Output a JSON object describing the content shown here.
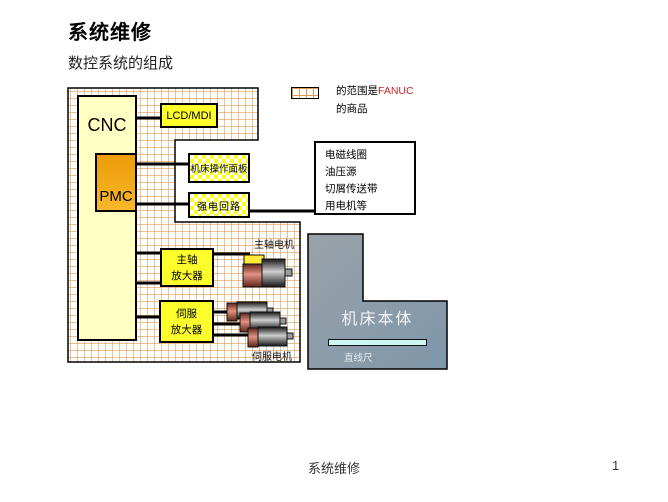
{
  "slide": {
    "title": "系统维修",
    "subtitle": "数控系统的组成",
    "footer_text": "系统维修",
    "page_number": "1"
  },
  "diagram": {
    "cnc_label": "CNC",
    "pmc_label": "PMC",
    "lcd_mdi_label": "LCD/MDI",
    "operator_panel_label": "机床操作面板",
    "power_circuit_label": "强电回路",
    "spindle_amp": {
      "line1": "主轴",
      "line2": "放大器"
    },
    "servo_amp": {
      "line1": "伺服",
      "line2": "放大器"
    },
    "spindle_motor_label": "主轴电机",
    "servo_motor_label": "伺服电机",
    "machine_body_label": "机床本体",
    "linear_scale_label": "直线尺",
    "external_devices": [
      "电磁线圈",
      "油压源",
      "切屑传送带",
      "用电机等"
    ],
    "legend": {
      "prefix": "的范围是",
      "brand": "FANUC",
      "suffix": "的商品"
    }
  },
  "colors": {
    "grid_line": "#dd9a55",
    "cnc_fill": "#ffffc4",
    "pmc_fill": "#f2a50c",
    "yellow_box": "#fdfd2b",
    "brand_red": "#cc2222",
    "motor_cap": "#e29384",
    "machine_body": "#8498a8",
    "linear_scale": "#ccf6f2"
  }
}
